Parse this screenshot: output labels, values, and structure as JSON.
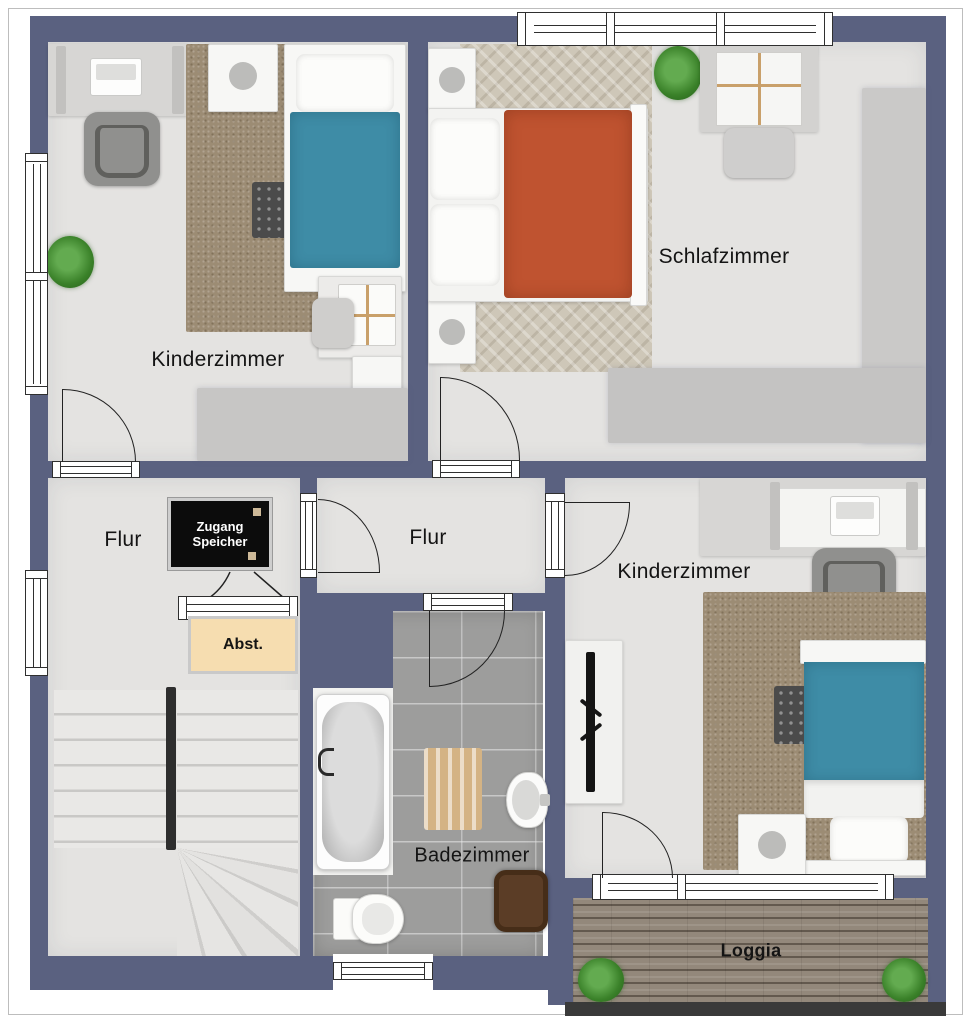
{
  "rooms": {
    "kinderzimmer_top_left": {
      "label": "Kinderzimmer"
    },
    "schlafzimmer": {
      "label": "Schlafzimmer"
    },
    "flur_left": {
      "label": "Flur"
    },
    "flur_middle": {
      "label": "Flur"
    },
    "kinderzimmer_right": {
      "label": "Kinderzimmer"
    },
    "badezimmer": {
      "label": "Badezimmer"
    },
    "loggia": {
      "label": "Loggia"
    },
    "abstellraum": {
      "label": "Abst."
    },
    "attic_access": {
      "label": "Zugang Speicher"
    }
  },
  "colors": {
    "wall": "#5a6180",
    "floor": "#e4e3e1",
    "bathroom_tile": "#9d9d9c",
    "bed_blue": "#3e8ca6",
    "bed_red": "#bf5330",
    "rug_brown": "#9c8c74",
    "loggia_wood": "#93887b",
    "storage_beige": "#f6ddb0",
    "attic_box": "#0c0c0c"
  }
}
